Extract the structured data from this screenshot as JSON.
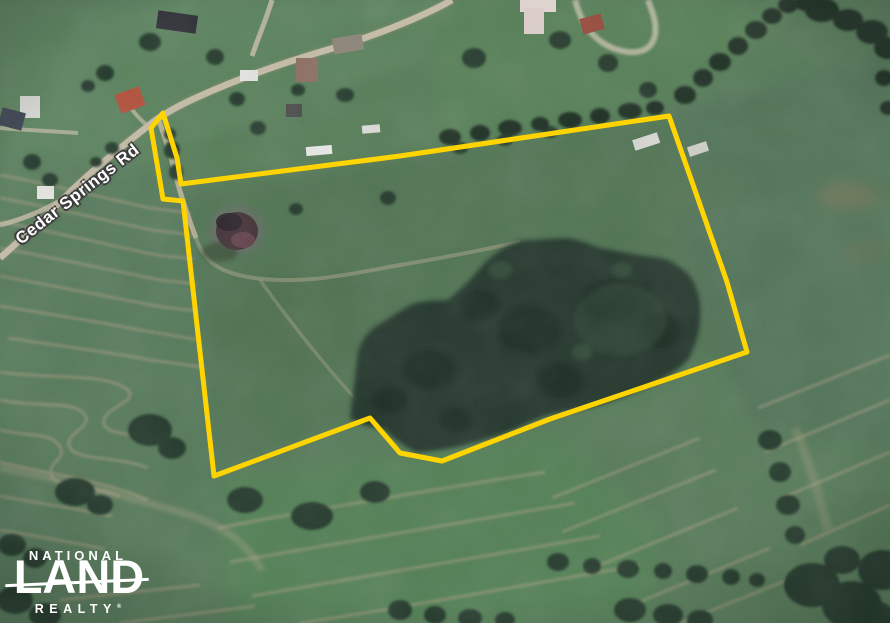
{
  "map": {
    "road_label": "Cedar Springs Rd",
    "boundary": {
      "color": "#FFD400",
      "stroke_width": "5",
      "points": "163,113 151,128 163,199 183,201 214,476 370,418 400,453 442,461 550,419 747,352 727,282 669,116 400,156 181,184 177,158"
    }
  },
  "logo": {
    "line1": "NATIONAL",
    "line2": "LAND",
    "line3": "REALTY",
    "trademark": "®",
    "color": "#FFFFFF"
  },
  "palette": {
    "field_green": "#567B59",
    "bright_field_green": "#4F7F53",
    "forest_green": "#223629",
    "road_tan": "#C9C0AA",
    "stripe_tan": "#AB9E82",
    "pond_dark": "#3F2E33",
    "boundary_yellow": "#FFD400",
    "label_white": "#FFFFFF"
  }
}
